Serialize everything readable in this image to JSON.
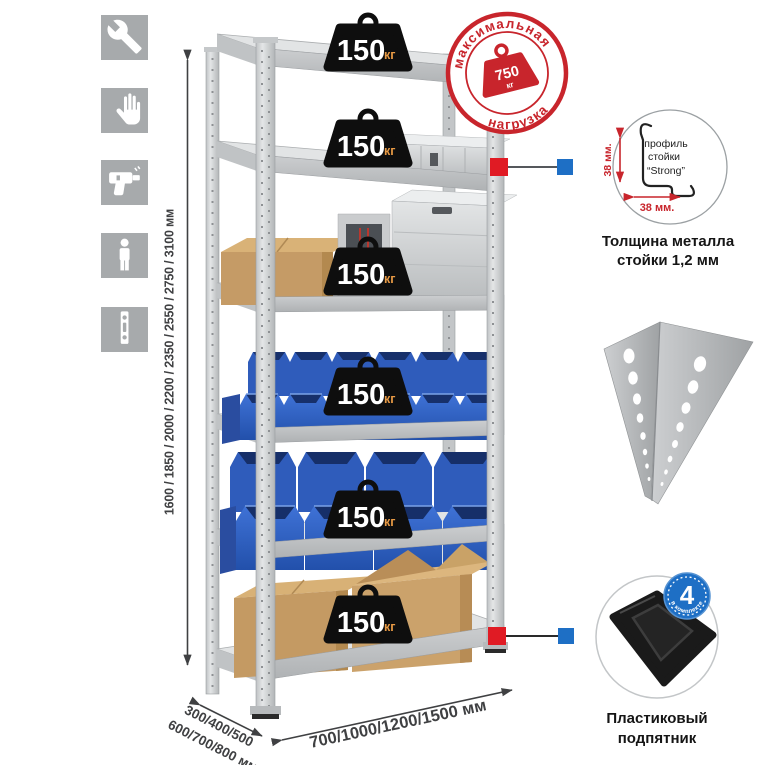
{
  "dimensions": {
    "height": "1600 / 1850 / 2000 / 2200 / 2350 / 2550 / 2750 / 3100 мм",
    "depth_line1": "300/400/500",
    "depth_line2": "600/700/800 мм",
    "width": "700/1000/1200/1500 мм"
  },
  "max_load_stamp": {
    "arc_top": "максимальная",
    "arc_bottom": "нагрузка",
    "weight_value": "750",
    "weight_unit": "кг"
  },
  "shelf_weights": {
    "unit": "кг",
    "items": [
      {
        "value": "150"
      },
      {
        "value": "150"
      },
      {
        "value": "150"
      },
      {
        "value": "150"
      },
      {
        "value": "150"
      },
      {
        "value": "150"
      }
    ]
  },
  "profile_callout": {
    "dim_vertical": "38 мм.",
    "dim_horizontal": "38 мм.",
    "label_line1": "профиль",
    "label_line2": "стойки",
    "label_line3": "“Strong”",
    "caption_line1": "Толщина металла",
    "caption_line2": "стойки 1,2 мм"
  },
  "foot_callout": {
    "badge_value": "4",
    "badge_label": "в комплекте",
    "caption_line1": "Пластиковый",
    "caption_line2": "подпятник"
  },
  "sidebar_icons": [
    {
      "name": "wrench-icon"
    },
    {
      "name": "gloves-icon"
    },
    {
      "name": "drill-icon"
    },
    {
      "name": "person-icon"
    },
    {
      "name": "profile-strip-icon"
    }
  ],
  "colors": {
    "accent_red": "#c8252c",
    "accent_blue": "#1e6fc5",
    "bin_blue": "#2e5fbe",
    "metal_gray": "#d7d9da",
    "cardboard": "#c59b66",
    "weight_black": "#0e0e0e",
    "unit_orange": "#e89a45",
    "icon_tile_gray": "#a7aaac",
    "dim_line_gray": "#3f4042"
  }
}
